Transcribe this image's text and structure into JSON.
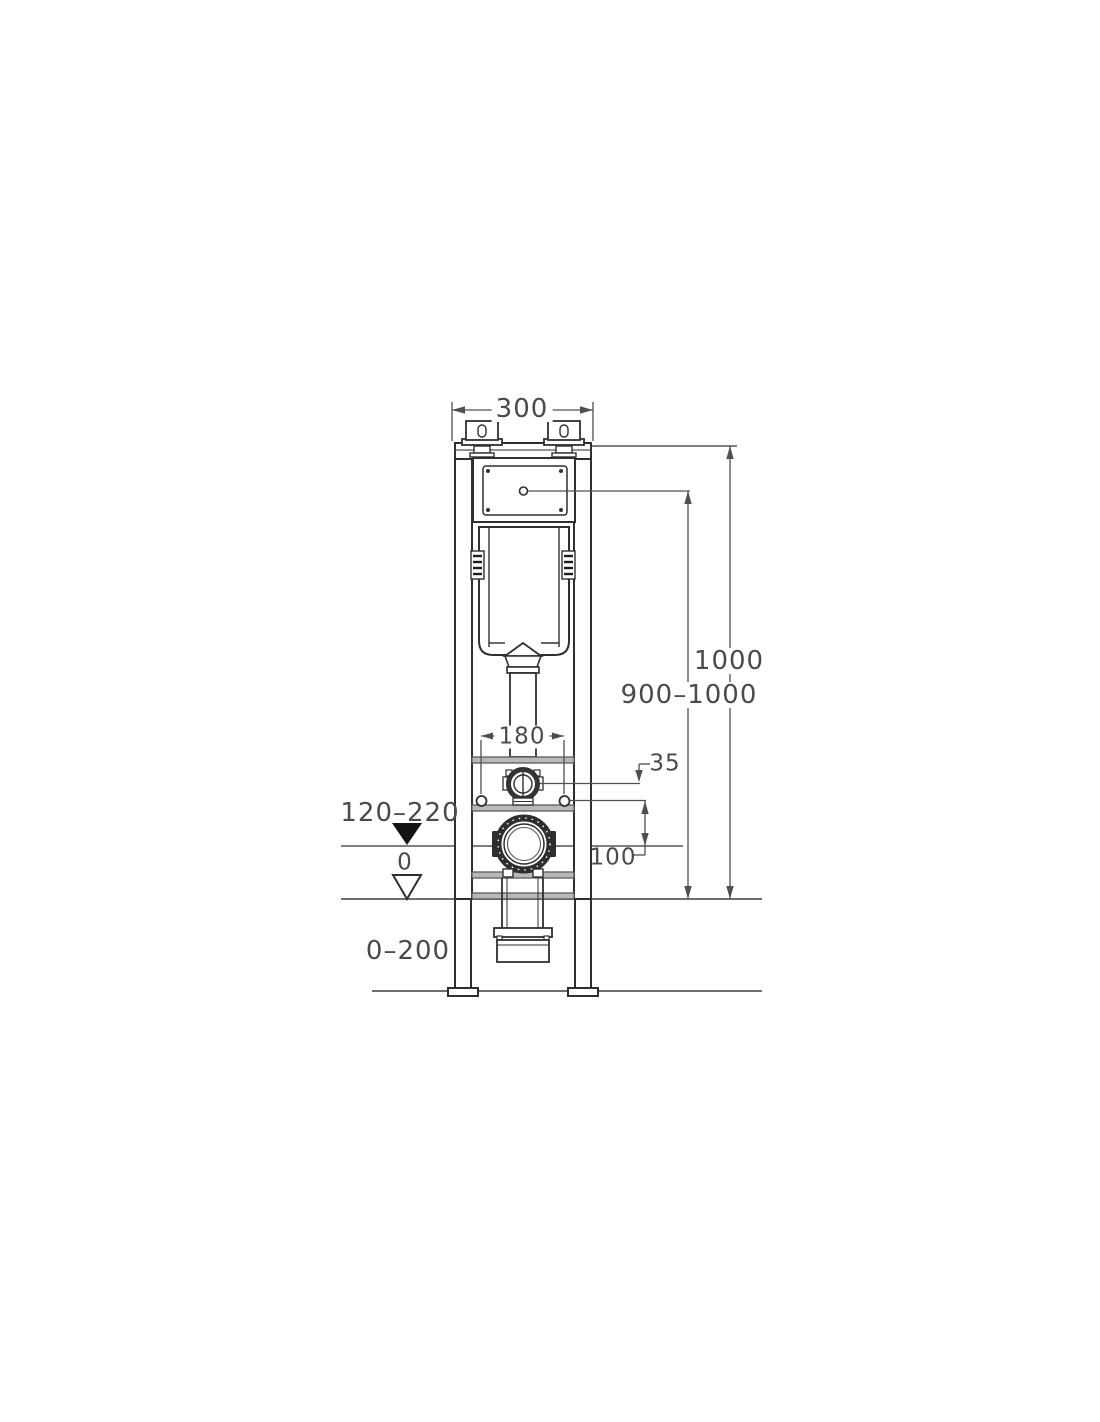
{
  "diagram": {
    "title": "concealed-cistern-frame-installation-drawing",
    "dimensions": {
      "frame_width": "300",
      "total_height": "1000",
      "panel_height_range": "900–1000",
      "bolt_spacing": "180",
      "inlet_offset": "35",
      "outlet_to_bolts": "100",
      "outlet_height_range": "120–220",
      "floor_level": "0",
      "leg_adjust_range": "0–200"
    },
    "colors": {
      "line_dark": "#2f2f2f",
      "line_dim": "#4f4f4f",
      "bar_fill": "#b8b8b8",
      "datum_fill": "#141414"
    }
  }
}
